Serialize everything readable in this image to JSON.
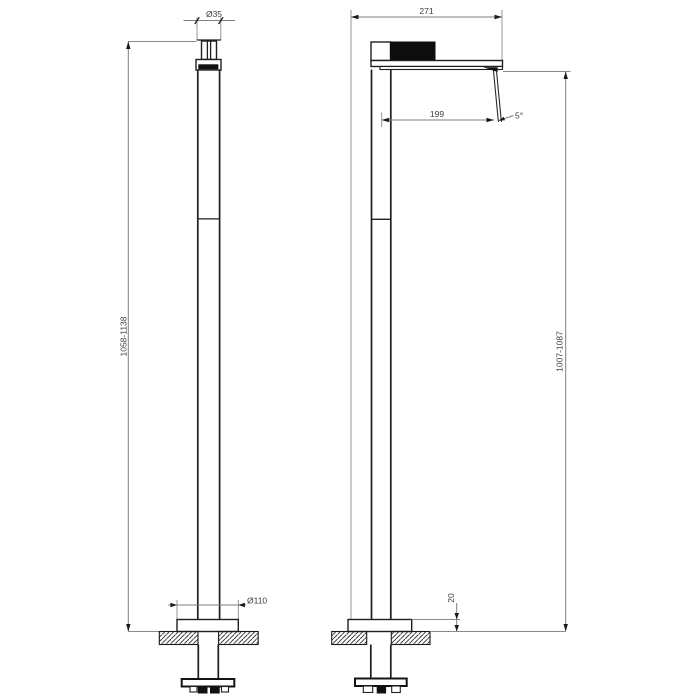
{
  "drawing": {
    "type": "freestanding-faucet-dimension-drawing",
    "labels": {
      "front_top_diameter": "Ø35",
      "front_height": "1058-1138",
      "front_base_diameter": "Ø110",
      "side_depth": "271",
      "side_reach": "199",
      "side_angle": "5°",
      "side_height": "1007-1087",
      "side_base_height": "20"
    },
    "colors": {
      "background": "#ffffff",
      "object_line": "#1f1f1f",
      "dimension_line": "#7f7f7f",
      "label_text": "#3d3d3d",
      "solid_fill": "#101010"
    }
  }
}
